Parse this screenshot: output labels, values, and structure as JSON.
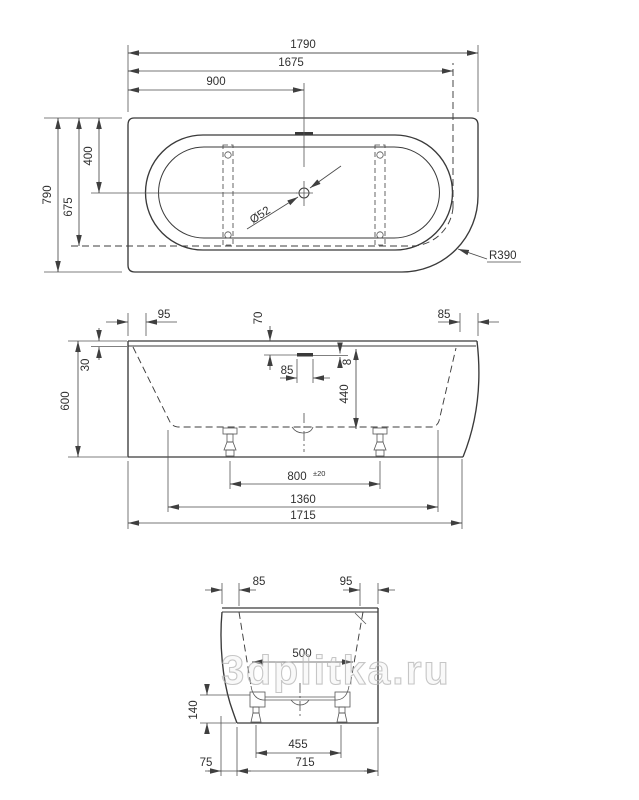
{
  "drawing": {
    "type": "bathtub technical drawing, three orthographic views",
    "watermark": "3dplitka.ru",
    "line_color": "#3a3a3a",
    "background": "#ffffff",
    "views": {
      "top": {
        "dims": {
          "total_length": "1790",
          "rim_length": "1675",
          "drain_offset_x": "900",
          "total_width": "790",
          "rim_width": "675",
          "drain_offset_y": "400",
          "drain_diameter": "Ø52",
          "corner_radius": "R390"
        }
      },
      "front": {
        "dims": {
          "rim_inset_left": "95",
          "overflow_from_top": "70",
          "rim_inset_right": "85",
          "rim_thickness": "30",
          "total_height": "600",
          "overflow_width": "85",
          "overflow_slot_height": "8",
          "inner_depth": "440",
          "feet_spacing": "800",
          "feet_tolerance": "±20",
          "base_span": "1360",
          "bottom_length": "1715"
        }
      },
      "side": {
        "dims": {
          "rim_inset_left": "85",
          "rim_inset_right": "95",
          "inner_width": "500",
          "base_height": "140",
          "feet_spacing": "455",
          "skirt_offset": "75",
          "bottom_width": "715"
        }
      }
    }
  }
}
